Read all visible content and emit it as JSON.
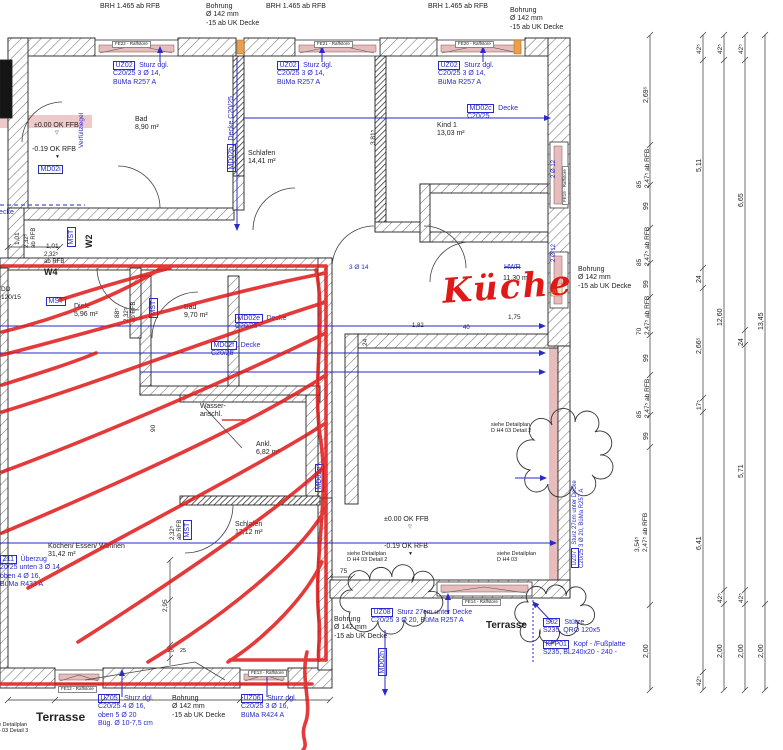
{
  "drawing": {
    "type": "architectural-floor-plan",
    "colors": {
      "annotation_blue": "#2929cc",
      "ink_black": "#222222",
      "marker_red": "#e01818",
      "orange": "#e07818",
      "wall_pink": "#e7bcbc",
      "gray": "#555555"
    },
    "labels": [
      {
        "name": "brh-label-1",
        "t": "BRH 1.465 ab RFB",
        "x": 100,
        "y": 3
      },
      {
        "name": "bohrung-top-1",
        "t": "Bohrung\nØ 142 mm\n-15 ab UK Decke",
        "x": 206,
        "y": 3
      },
      {
        "name": "brh-label-2",
        "t": "BRH 1.465 ab RFB",
        "x": 266,
        "y": 3
      },
      {
        "name": "brh-label-3",
        "t": "BRH 1.465 ab RFB",
        "x": 428,
        "y": 3
      },
      {
        "name": "bohrung-top-2",
        "t": "Bohrung\nØ 142 mm\n-15 ab UK Decke",
        "x": 510,
        "y": 7
      },
      {
        "name": "window-label-fe22",
        "t": "FE22 - Raffstore",
        "x": 112,
        "y": 41,
        "s": 4.5,
        "wl": true
      },
      {
        "name": "window-label-fe21",
        "t": "FE21 - Raffstore",
        "x": 314,
        "y": 41,
        "s": 4.5,
        "wl": true
      },
      {
        "name": "window-label-fe20",
        "t": "FE20 - Raffstore",
        "x": 455,
        "y": 41,
        "s": 4.5,
        "wl": true
      },
      {
        "name": "lintel-uz02-1",
        "box": "UZ02",
        "lines": [
          "Sturz dgl.",
          "C20/25 3 Ø 14,",
          "BüMa R257 A"
        ],
        "x": 113,
        "y": 62,
        "c": "blue"
      },
      {
        "name": "lintel-uz02-2",
        "box": "UZ02",
        "lines": [
          "Sturz dgl.",
          "C20/25 3 Ø 14,",
          "BüMa R257 A"
        ],
        "x": 277,
        "y": 62,
        "c": "blue"
      },
      {
        "name": "lintel-uz02-3",
        "box": "UZ02",
        "lines": [
          "Sturz dgl.",
          "C20/25 3 Ø 14,",
          "BüMa R257 A"
        ],
        "x": 438,
        "y": 62,
        "c": "blue"
      },
      {
        "name": "slab-md02c",
        "box": "MD02c",
        "lines": [
          "Decke",
          "C20/25"
        ],
        "x": 467,
        "y": 105,
        "c": "blue"
      },
      {
        "name": "room-kind1",
        "t": "Kind 1\n13,03 m²",
        "x": 437,
        "y": 122
      },
      {
        "name": "room-bad-1",
        "t": "Bad\n8,90 m²",
        "x": 135,
        "y": 116
      },
      {
        "name": "room-schlafen-1",
        "t": "Schlafen\n14,41 m²",
        "x": 248,
        "y": 150
      },
      {
        "name": "slab-md02b",
        "box": "MD02b",
        "lines": [
          "Decke C20/25"
        ],
        "x": 228,
        "y": 172,
        "r": -90,
        "c": "blue"
      },
      {
        "name": "verfuellziegel-note",
        "t": "Verfüllziegel",
        "x": 78,
        "y": 148,
        "r": -90,
        "c": "blue",
        "s": 6.5
      },
      {
        "name": "level-okffb-1",
        "t": "±0.00 OK FFB",
        "x": 34,
        "y": 122
      },
      {
        "name": "level-mark-1",
        "t": "▽",
        "x": 55,
        "y": 131,
        "s": 5
      },
      {
        "name": "level-okrfb-1",
        "t": "-0.19 OK RFB",
        "x": 32,
        "y": 146
      },
      {
        "name": "level-mark-2",
        "t": "▼",
        "x": 55,
        "y": 155,
        "s": 5
      },
      {
        "name": "slab-md02i",
        "box": "MD02i",
        "lines": [],
        "x": 38,
        "y": 166,
        "c": "blue"
      },
      {
        "name": "slab-decke-cut",
        "t": "Decke",
        "x": -6,
        "y": 209,
        "c": "blue"
      },
      {
        "name": "wall-tag-w2",
        "t": "W2",
        "x": 84,
        "y": 248,
        "r": -90,
        "b": true,
        "s": 9
      },
      {
        "name": "mst-tag-1",
        "box": "MST",
        "lines": [],
        "x": 68,
        "y": 247,
        "r": -90,
        "c": "blue"
      },
      {
        "name": "dim-101-v",
        "t": "1,01",
        "x": 14,
        "y": 245,
        "r": -90,
        "s": 6.5
      },
      {
        "name": "dim-232-v1",
        "t": "2,32⁵\nab RFB",
        "x": 24,
        "y": 248,
        "r": -90,
        "s": 6
      },
      {
        "name": "dim-101-h",
        "t": "1,01",
        "x": 46,
        "y": 243,
        "s": 6.5
      },
      {
        "name": "dim-232-h",
        "t": "2,32⁵\nab RFB",
        "x": 44,
        "y": 252,
        "s": 6
      },
      {
        "name": "wall-tag-w4",
        "t": "W4",
        "x": 44,
        "y": 267,
        "b": true,
        "s": 9
      },
      {
        "name": "dd-tag",
        "t": "DD\n120/15",
        "x": 1,
        "y": 286,
        "s": 6.5
      },
      {
        "name": "mst-tag-2",
        "box": "MST",
        "lines": [],
        "x": 46,
        "y": 298,
        "c": "blue"
      },
      {
        "name": "room-diele",
        "t": "Diele\n5,96 m²",
        "x": 74,
        "y": 303
      },
      {
        "name": "dim-885",
        "t": "88⁵",
        "x": 114,
        "y": 318,
        "r": -90,
        "s": 6.5
      },
      {
        "name": "dim-232-v2",
        "t": "2,32⁵\nab RFB",
        "x": 124,
        "y": 322,
        "r": -90,
        "s": 6
      },
      {
        "name": "mst-tag-3",
        "box": "MST",
        "lines": [],
        "x": 150,
        "y": 318,
        "r": -90,
        "c": "blue"
      },
      {
        "name": "room-bad-2",
        "t": "Bad\n9,70 m²",
        "x": 184,
        "y": 304
      },
      {
        "name": "slab-md02e",
        "box": "MD02e",
        "lines": [
          "Decke",
          "C20/25"
        ],
        "x": 235,
        "y": 315,
        "c": "blue"
      },
      {
        "name": "slab-md02f",
        "box": "MD02f",
        "lines": [
          "Decke",
          "C20/25"
        ],
        "x": 211,
        "y": 342,
        "c": "blue"
      },
      {
        "name": "rebar-3o14",
        "t": "3 Ø 14",
        "x": 349,
        "y": 264,
        "c": "blue",
        "s": 6.5
      },
      {
        "name": "room-hwr-struck",
        "t": "HWR",
        "x": 504,
        "y": 264,
        "c": "blue",
        "strike": true
      },
      {
        "name": "room-kueche-area",
        "t": "11,30 m²",
        "x": 503,
        "y": 275
      },
      {
        "name": "kueche-handwriting",
        "t": "Küche",
        "x": 441,
        "y": 272,
        "c": "red",
        "s": 34,
        "r": -4,
        "hand": true
      },
      {
        "name": "bohrung-right",
        "t": "Bohrung\nØ 142 mm\n-15 ab UK Decke",
        "x": 578,
        "y": 266
      },
      {
        "name": "zu-mark",
        "t": "zu",
        "x": 552,
        "y": 289,
        "c": "orange",
        "s": 6
      },
      {
        "name": "dim-175",
        "t": "1,75",
        "x": 508,
        "y": 314,
        "s": 6.5
      },
      {
        "name": "dim-182",
        "t": "1,82",
        "x": 412,
        "y": 323,
        "s": 6
      },
      {
        "name": "dim-40",
        "t": "40",
        "x": 463,
        "y": 325,
        "s": 6
      },
      {
        "name": "rebar-2o12-1",
        "t": "2 Ø 12",
        "x": 551,
        "y": 178,
        "r": -90,
        "c": "blue",
        "s": 6
      },
      {
        "name": "rebar-2o12-2",
        "t": "2 Ø 12",
        "x": 551,
        "y": 262,
        "r": -90,
        "c": "blue",
        "s": 6
      },
      {
        "name": "dim-24-wall",
        "t": "24",
        "x": 362,
        "y": 346,
        "r": -90,
        "s": 6.5
      },
      {
        "name": "wasseranschluss",
        "t": "Wasser-\nanschl.",
        "x": 200,
        "y": 403
      },
      {
        "name": "room-ankleide",
        "t": "Ankl.\n6,82 m²",
        "x": 256,
        "y": 441
      },
      {
        "name": "slab-md02g",
        "box": "MD02g",
        "lines": [],
        "x": 316,
        "y": 492,
        "r": -90,
        "c": "blue"
      },
      {
        "name": "dim-90",
        "t": "90",
        "x": 150,
        "y": 432,
        "r": -90,
        "s": 6.5
      },
      {
        "name": "detail-ref-1",
        "t": "siehe Detailplan\nD H4 03 Detail 2",
        "x": 491,
        "y": 422,
        "s": 5.5
      },
      {
        "name": "lintel-uz07",
        "box": "UZ07",
        "lines": [
          "Sturz 27cm unter Decke",
          "C20/25 3 Ø 20, BüMa R257 A"
        ],
        "x": 572,
        "y": 568,
        "r": -90,
        "c": "blue",
        "s": 6
      },
      {
        "name": "room-schlafen-2",
        "t": "Schlafen\n12,12 m²",
        "x": 235,
        "y": 521
      },
      {
        "name": "mst-tag-4",
        "box": "MST",
        "lines": [],
        "x": 184,
        "y": 540,
        "r": -90,
        "c": "blue"
      },
      {
        "name": "dim-232-v3",
        "t": "2,32⁵\nab RFB",
        "x": 170,
        "y": 540,
        "r": -90,
        "s": 6
      },
      {
        "name": "level-okffb-2",
        "t": "±0.00 OK FFB",
        "x": 384,
        "y": 516
      },
      {
        "name": "level-mark-3",
        "t": "▽",
        "x": 408,
        "y": 525,
        "s": 5
      },
      {
        "name": "level-okrfb-2",
        "t": "-0.19 OK RFB",
        "x": 384,
        "y": 543
      },
      {
        "name": "level-mark-4",
        "t": "▼",
        "x": 408,
        "y": 552,
        "s": 5
      },
      {
        "name": "detail-ref-2",
        "t": "siehe Detailplan\nD H4 03 Detail 2",
        "x": 347,
        "y": 551,
        "s": 5.5
      },
      {
        "name": "detail-ref-3",
        "t": "siehe Detailplan\nD H4 03",
        "x": 497,
        "y": 551,
        "s": 5.5
      },
      {
        "name": "room-kochen",
        "t": "Kochen/ Essen/ Wohnen\n31,42 m²",
        "x": 48,
        "y": 543
      },
      {
        "name": "beam-z11",
        "box": "Z11",
        "lines": [
          "Überzug",
          "20/25 unten 3 Ø 14,",
          "oben 4 Ø 16,",
          "BüMa R433 A"
        ],
        "x": 0,
        "y": 556,
        "c": "blue"
      },
      {
        "name": "dim-75",
        "t": "75",
        "x": 340,
        "y": 568,
        "s": 6.5
      },
      {
        "name": "lintel-uz08",
        "box": "UZ08",
        "lines": [
          "Sturz 27cm unter Decke",
          "C20/25 3 Ø 20, BüMa R257 A"
        ],
        "x": 371,
        "y": 609,
        "c": "blue"
      },
      {
        "name": "bohrung-bottom-mid",
        "t": "Bohrung\nØ 142 mm\n-15 ab UK Decke",
        "x": 334,
        "y": 616
      },
      {
        "name": "slab-md02h",
        "box": "MD02h",
        "lines": [],
        "x": 379,
        "y": 676,
        "r": -90,
        "c": "blue"
      },
      {
        "name": "terrasse-right",
        "t": "Terrasse",
        "x": 486,
        "y": 620,
        "b": true,
        "s": 10
      },
      {
        "name": "column-s02",
        "box": "S02",
        "lines": [
          "Stütze",
          "S235, QRO 120x5"
        ],
        "x": 543,
        "y": 619,
        "c": "blue"
      },
      {
        "name": "plate-kfp01",
        "box": "KFP01",
        "lines": [
          "Kopf - /Fußplatte",
          "S235, BL240x20 - 240 -"
        ],
        "x": 543,
        "y": 641,
        "c": "blue"
      },
      {
        "name": "window-label-fe14",
        "t": "FE14 - Raffstore",
        "x": 462,
        "y": 599,
        "s": 4.5,
        "wl": true
      },
      {
        "name": "window-label-fe19",
        "t": "FE19 - Raffstore",
        "x": 562,
        "y": 205,
        "r": -90,
        "s": 4.5,
        "wl": true
      },
      {
        "name": "dim-381",
        "t": "3,81⁵",
        "x": 370,
        "y": 145,
        "r": -90,
        "s": 6.5
      },
      {
        "name": "terrasse-left",
        "t": "Terrasse",
        "x": 36,
        "y": 710,
        "b": true,
        "s": 12
      },
      {
        "name": "detail-ref-4",
        "t": "siehe Detailplan\nD H4 03 Detail 3",
        "x": -12,
        "y": 722,
        "s": 5.5
      },
      {
        "name": "lintel-uz05",
        "box": "UZ05",
        "lines": [
          "Sturz dgl.",
          "C20/25 4 Ø 16,",
          "oben 5 Ø 20",
          "Büg. Ø 10-7,5 cm"
        ],
        "x": 98,
        "y": 695,
        "c": "blue"
      },
      {
        "name": "bohrung-bottom-left",
        "t": "Bohrung\nØ 142 mm\n-15 ab UK Decke",
        "x": 172,
        "y": 695
      },
      {
        "name": "lintel-uz06",
        "box": "UZ06",
        "lines": [
          "Sturz dgl.",
          "C20/25 3 Ø 16,",
          "BüMa R424 A"
        ],
        "x": 241,
        "y": 695,
        "c": "blue"
      },
      {
        "name": "window-label-fe13",
        "t": "FE13 - Raffstore",
        "x": 248,
        "y": 670,
        "s": 4.5,
        "wl": true
      },
      {
        "name": "window-label-fe12",
        "t": "FE12 - Raffstore",
        "x": 58,
        "y": 686,
        "s": 4.5,
        "wl": true
      },
      {
        "name": "dim-295",
        "t": "2,95",
        "x": 162,
        "y": 612,
        "r": -90,
        "s": 6.5
      },
      {
        "name": "dim-25a",
        "t": "25",
        "x": 168,
        "y": 648,
        "s": 5.5
      },
      {
        "name": "dim-25b",
        "t": "25",
        "x": 180,
        "y": 648,
        "s": 5.5
      },
      {
        "name": "rdim-269",
        "t": "2,69⁵",
        "x": 643,
        "y": 103,
        "r": -90,
        "s": 7
      },
      {
        "name": "rdim-85a",
        "t": "85\n2,47⁵ ab RFB",
        "x": 636,
        "y": 188,
        "r": -90,
        "s": 6.5
      },
      {
        "name": "rdim-99a",
        "t": "99",
        "x": 643,
        "y": 210,
        "r": -90,
        "s": 7
      },
      {
        "name": "rdim-85b",
        "t": "85\n2,47⁵ ab RFB",
        "x": 636,
        "y": 266,
        "r": -90,
        "s": 6.5
      },
      {
        "name": "rdim-99b",
        "t": "99",
        "x": 643,
        "y": 288,
        "r": -90,
        "s": 7
      },
      {
        "name": "rdim-70",
        "t": "70\n2,47⁵ ab RFB",
        "x": 636,
        "y": 335,
        "r": -90,
        "s": 6.5
      },
      {
        "name": "rdim-99c",
        "t": "99",
        "x": 643,
        "y": 362,
        "r": -90,
        "s": 7
      },
      {
        "name": "rdim-85c",
        "t": "85\n2,47⁵ ab RFB",
        "x": 636,
        "y": 418,
        "r": -90,
        "s": 6.5
      },
      {
        "name": "rdim-99d",
        "t": "99",
        "x": 643,
        "y": 440,
        "r": -90,
        "s": 7
      },
      {
        "name": "rdim-354",
        "t": "3,54⁵\n2,47⁵ ab RFB",
        "x": 634,
        "y": 552,
        "r": -90,
        "s": 6.5
      },
      {
        "name": "rdim-200a",
        "t": "2,00",
        "x": 643,
        "y": 658,
        "r": -90,
        "s": 7
      },
      {
        "name": "rdim-425a",
        "t": "42⁵",
        "x": 696,
        "y": 54,
        "r": -90,
        "s": 6.5
      },
      {
        "name": "rdim-511",
        "t": "5,11",
        "x": 696,
        "y": 172,
        "r": -90,
        "s": 7
      },
      {
        "name": "rdim-24a",
        "t": "24",
        "x": 696,
        "y": 283,
        "r": -90,
        "s": 7
      },
      {
        "name": "rdim-266",
        "t": "2,66⁵",
        "x": 696,
        "y": 354,
        "r": -90,
        "s": 7
      },
      {
        "name": "rdim-175v",
        "t": "17⁵",
        "x": 696,
        "y": 410,
        "r": -90,
        "s": 6.5
      },
      {
        "name": "rdim-641",
        "t": "6,41",
        "x": 696,
        "y": 550,
        "r": -90,
        "s": 7
      },
      {
        "name": "rdim-425b",
        "t": "42⁵",
        "x": 696,
        "y": 686,
        "r": -90,
        "s": 6.5
      },
      {
        "name": "rdim-425c",
        "t": "42⁵",
        "x": 717,
        "y": 54,
        "r": -90,
        "s": 6.5
      },
      {
        "name": "rdim-1260",
        "t": "12,60",
        "x": 717,
        "y": 326,
        "r": -90,
        "s": 7
      },
      {
        "name": "rdim-425d",
        "t": "42⁵",
        "x": 717,
        "y": 603,
        "r": -90,
        "s": 6.5
      },
      {
        "name": "rdim-200b",
        "t": "2,00",
        "x": 717,
        "y": 658,
        "r": -90,
        "s": 7
      },
      {
        "name": "rdim-425e",
        "t": "42⁵",
        "x": 738,
        "y": 54,
        "r": -90,
        "s": 6.5
      },
      {
        "name": "rdim-665",
        "t": "6,65",
        "x": 738,
        "y": 207,
        "r": -90,
        "s": 7
      },
      {
        "name": "rdim-24b",
        "t": "24",
        "x": 738,
        "y": 346,
        "r": -90,
        "s": 7
      },
      {
        "name": "rdim-571",
        "t": "5,71",
        "x": 738,
        "y": 478,
        "r": -90,
        "s": 7
      },
      {
        "name": "rdim-425f",
        "t": "42⁵",
        "x": 738,
        "y": 603,
        "r": -90,
        "s": 6.5
      },
      {
        "name": "rdim-200c",
        "t": "2,00",
        "x": 738,
        "y": 658,
        "r": -90,
        "s": 7
      },
      {
        "name": "rdim-1345",
        "t": "13,45",
        "x": 758,
        "y": 330,
        "r": -90,
        "s": 7
      },
      {
        "name": "rdim-200d",
        "t": "2,00",
        "x": 758,
        "y": 658,
        "r": -90,
        "s": 7
      }
    ]
  }
}
